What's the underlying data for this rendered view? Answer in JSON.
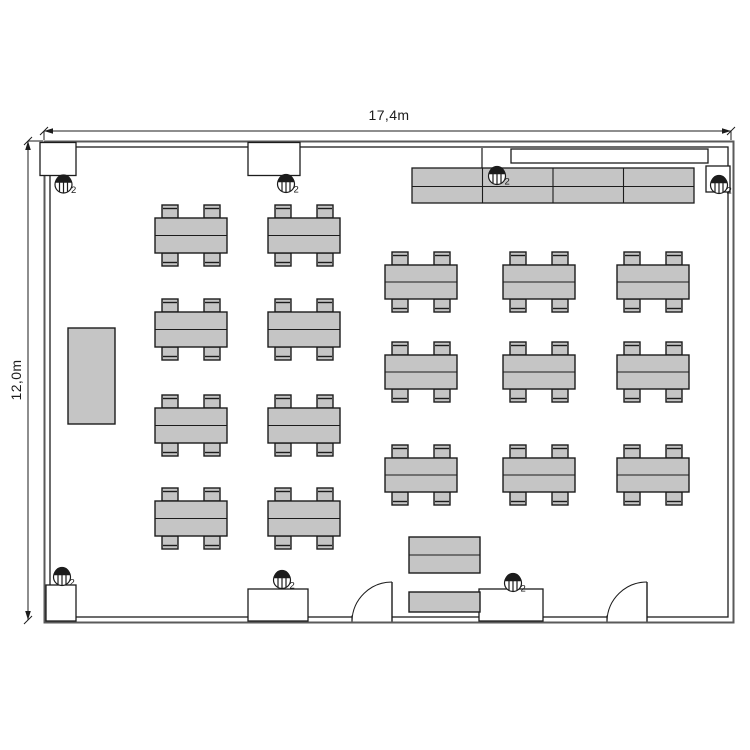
{
  "dimension_labels": {
    "top": "17,4m",
    "left": "12,0m"
  },
  "colors": {
    "background": "#ffffff",
    "line": "#1c1c1c",
    "wall_outer": "#5a5a5a",
    "furniture_fill": "#c5c5c5",
    "text": "#1c1c1c"
  },
  "plan": {
    "outer_wall": {
      "x": 44.5,
      "y": 141.5,
      "w": 689,
      "h": 481
    },
    "inner_wall": {
      "x": 50,
      "y": 147,
      "w": 678,
      "h": 470
    },
    "dim_top": {
      "y": 131,
      "x1": 44,
      "x2": 731
    },
    "dim_left": {
      "x": 28,
      "y1": 141,
      "y2": 620
    },
    "pillars": [
      {
        "x": 40,
        "y": 142.5,
        "w": 36,
        "h": 33
      },
      {
        "x": 248,
        "y": 142.5,
        "w": 52,
        "h": 33
      },
      {
        "x": 706,
        "y": 166,
        "w": 24,
        "h": 26
      },
      {
        "x": 46,
        "y": 585,
        "w": 30,
        "h": 36
      },
      {
        "x": 248,
        "y": 589,
        "w": 60,
        "h": 32
      },
      {
        "x": 479,
        "y": 589,
        "w": 64,
        "h": 32
      }
    ],
    "door_openings": [
      {
        "x1": 352,
        "x2": 392
      },
      {
        "x1": 607,
        "x2": 647
      }
    ],
    "markers": [
      {
        "x": 63.5,
        "y": 184.5,
        "label": "2"
      },
      {
        "x": 286,
        "y": 184,
        "label": "2"
      },
      {
        "x": 497,
        "y": 176,
        "label": "2"
      },
      {
        "x": 719,
        "y": 185,
        "label": "2"
      },
      {
        "x": 62,
        "y": 577,
        "label": "2"
      },
      {
        "x": 282,
        "y": 580,
        "label": "2"
      },
      {
        "x": 513,
        "y": 583,
        "label": "2"
      }
    ],
    "whiteboard": {
      "x": 511,
      "y": 149,
      "w": 197,
      "h": 14
    },
    "counter": {
      "x": 412,
      "y": 168,
      "w": 282,
      "h": 35,
      "cols": 4,
      "rows": 2,
      "connector_x": 482
    },
    "cabinet": {
      "x": 68,
      "y": 328,
      "w": 47,
      "h": 96
    },
    "table_blocks": [
      {
        "name": "left-table-block",
        "cols": [
          155,
          268
        ],
        "rows": [
          218,
          312,
          408,
          501
        ],
        "tw": 72,
        "th": 35
      },
      {
        "name": "right-table-block",
        "cols": [
          385,
          503,
          617
        ],
        "rows": [
          265,
          355,
          458
        ],
        "tw": 72,
        "th": 34
      }
    ],
    "chair": {
      "w": 16,
      "h": 13,
      "insets": [
        7,
        49
      ]
    },
    "bottom_tables": [
      {
        "x": 409,
        "y": 537,
        "w": 71,
        "h": 36,
        "split": true
      },
      {
        "x": 409,
        "y": 592,
        "w": 71,
        "h": 20,
        "split": false
      }
    ]
  }
}
